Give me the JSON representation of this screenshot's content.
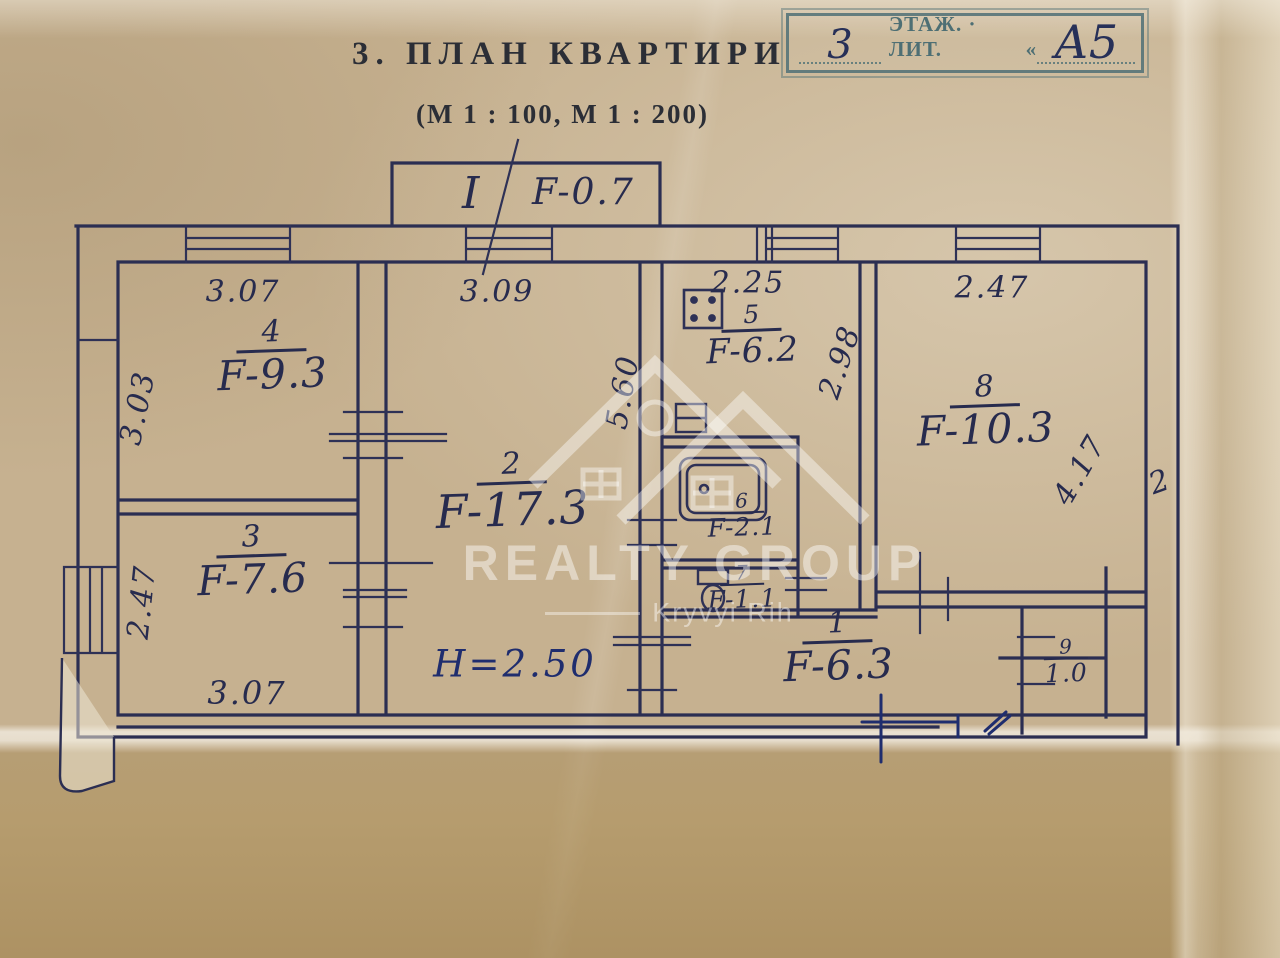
{
  "header": {
    "title": "3. ПЛАН КВАРТИРИ",
    "scale": "(М 1 : 100, М 1 : 200)"
  },
  "stamp": {
    "floor_value": "3",
    "label": "ЭТАЖ. · ЛИТ.",
    "quote": "«",
    "liter_value": "А5"
  },
  "balcony": {
    "roman": "I",
    "area": "F-0.7"
  },
  "rooms": {
    "r1": {
      "number": "1",
      "area": "F-6.3"
    },
    "r2": {
      "number": "2",
      "area": "F-17.3"
    },
    "r3": {
      "number": "3",
      "area": "F-7.6"
    },
    "r4": {
      "number": "4",
      "area": "F-9.3"
    },
    "r5": {
      "number": "5",
      "area": "F-6.2"
    },
    "r6": {
      "number": "6",
      "area": "F-2.1"
    },
    "r7": {
      "number": "7",
      "area": "F-1.1"
    },
    "r8": {
      "number": "8",
      "area": "F-10.3"
    },
    "r9": {
      "number": "9",
      "area": "1.0"
    }
  },
  "dimensions": {
    "room4_top": "3.07",
    "room4_left": "3.03",
    "room2_top": "3.09",
    "kitchen_top": "2.25",
    "kitchen_right": "2.98",
    "room8_top": "2.47",
    "room8_right": "4.17",
    "room3_left": "2.47",
    "room3_bottom": "3.07",
    "hall_vertical": "5.60",
    "right_edge_mark": "2"
  },
  "notes": {
    "ceiling_height": "H=2.50"
  },
  "watermark": {
    "line1": "REALTY GROUP",
    "line2": "Kryvyi Rih"
  },
  "colors": {
    "ink": "#272b4e",
    "stamp": "#4e6f74",
    "paper": "#c6b190",
    "blue_ink": "#1f2d6e"
  }
}
